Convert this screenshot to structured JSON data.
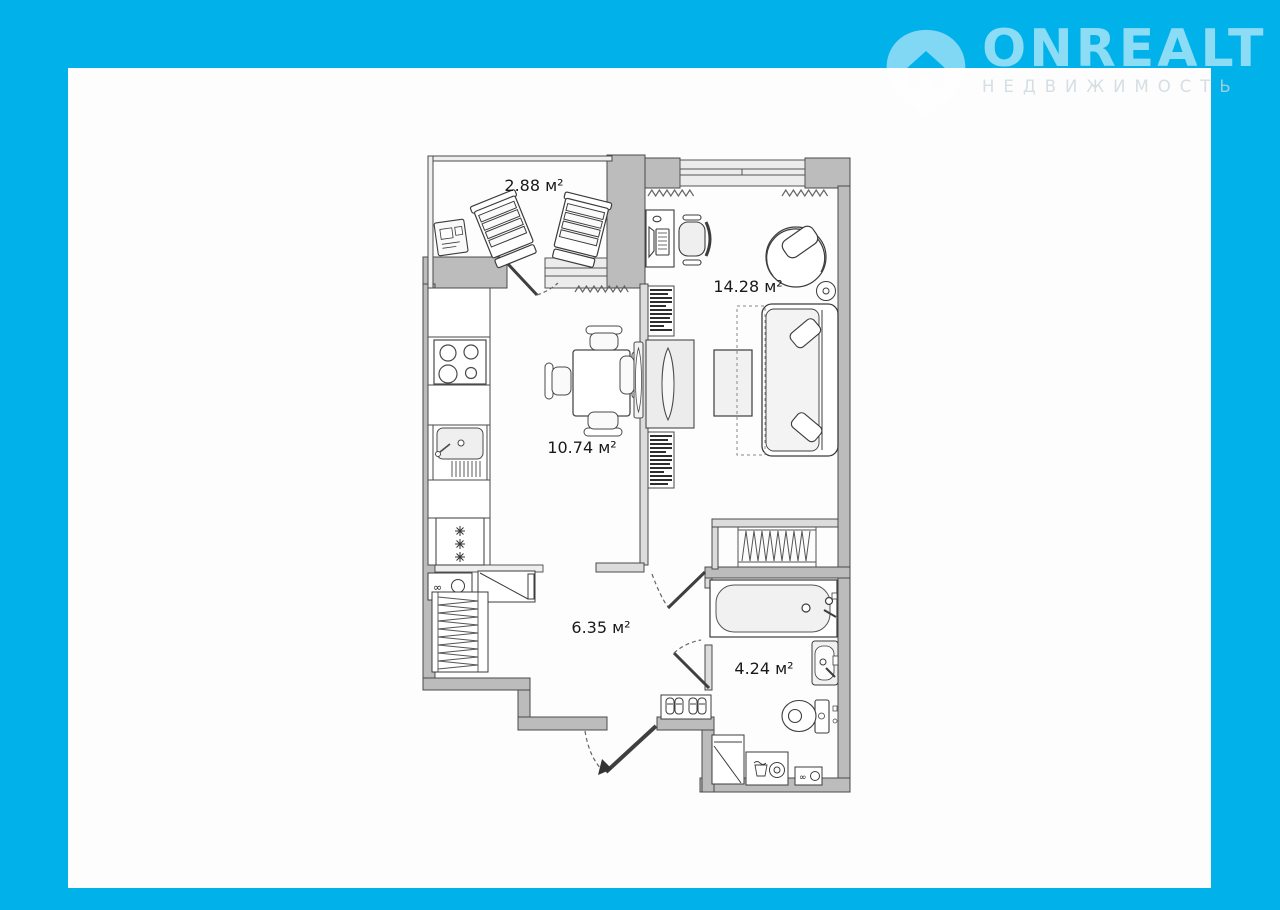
{
  "brand": {
    "name": "ONREALT",
    "tagline": "НЕДВИЖИМОСТЬ"
  },
  "colors": {
    "background": "#00b1ea",
    "card": "#fdfdfd",
    "wall_fill": "#bcbcbc",
    "thin_wall_fill": "#dcdcdc",
    "line": "#4a4a4a"
  },
  "floor_plan": {
    "rooms": [
      {
        "id": "balcony",
        "area_label": "2.88 м²"
      },
      {
        "id": "kitchen",
        "area_label": "10.74 м²"
      },
      {
        "id": "living_room",
        "area_label": "14.28 м²"
      },
      {
        "id": "hallway",
        "area_label": "6.35 м²"
      },
      {
        "id": "bathroom",
        "area_label": "4.24 м²"
      }
    ]
  }
}
